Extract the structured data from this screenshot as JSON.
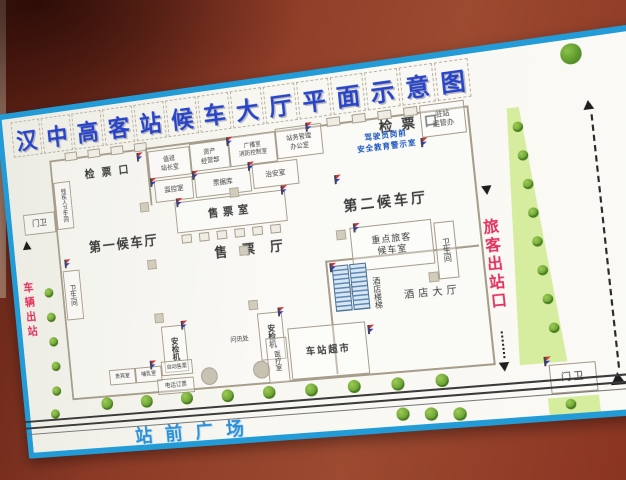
{
  "colors": {
    "wall": "#8a3a26",
    "sign_background": "#f6f4ee",
    "sign_border_blue": "#229bd7",
    "title_blue": "#2744c9",
    "plaza_blue": "#2e8fd6",
    "road_red": "#e3305e",
    "green_strip": "#d6ec9e",
    "tree_green": "#5f9a2c",
    "wall_line": "#a69d8b",
    "safety_text_blue": "#1a55c0"
  },
  "title": {
    "text": "汉中高客站候车大厅平面示意图",
    "chars": [
      "汉",
      "中",
      "高",
      "客",
      "站",
      "候",
      "车",
      "大",
      "厅",
      "平",
      "面",
      "示",
      "意",
      "图"
    ]
  },
  "compass": {
    "label": "N"
  },
  "roads": {
    "vehicle_exit": "车辆出站",
    "vehicle_entry": "车辆进站",
    "passenger_exit": "旅客出站口",
    "plaza": "站前广场"
  },
  "building": {
    "gate_left": "检票口",
    "gate_right": "检票口",
    "hall_first": "第一候车厅",
    "hall_second": "第二候车厅",
    "ticket_office": "售票室",
    "ticket_hall": "售票厅",
    "rooms": {
      "duty_master": "值班\n站长室",
      "asset_mgmt": "资产\n经营部",
      "broadcast_fire": "广播室\n消防控制室",
      "station_admin": "站务管理\n办公室",
      "monitor": "监控室",
      "ticket_stub": "票据库",
      "security": "治安室",
      "driver_safety": "驾驶员岗前\n安全教育警示室",
      "transport_office": "驻站\n运管办",
      "vip_waiting": "重点旅客\n候车室",
      "toilet_right": "卫生间",
      "toilet_left": "卫生间",
      "disabled_toilet": "残疾人卫生间",
      "security_machine": "安检机",
      "info_desk": "问讯处",
      "vip_room": "贵宾室",
      "nursing_room": "哺乳室",
      "auto_ticket": "自动售票",
      "phone_booking": "电话订票",
      "medical": "医疗室",
      "supermarket": "车站超市",
      "hotel_stairs": "酒店楼梯",
      "hotel_lobby": "酒店大厅",
      "gatehouse_left": "门卫",
      "gatehouse_right": "门卫"
    }
  }
}
